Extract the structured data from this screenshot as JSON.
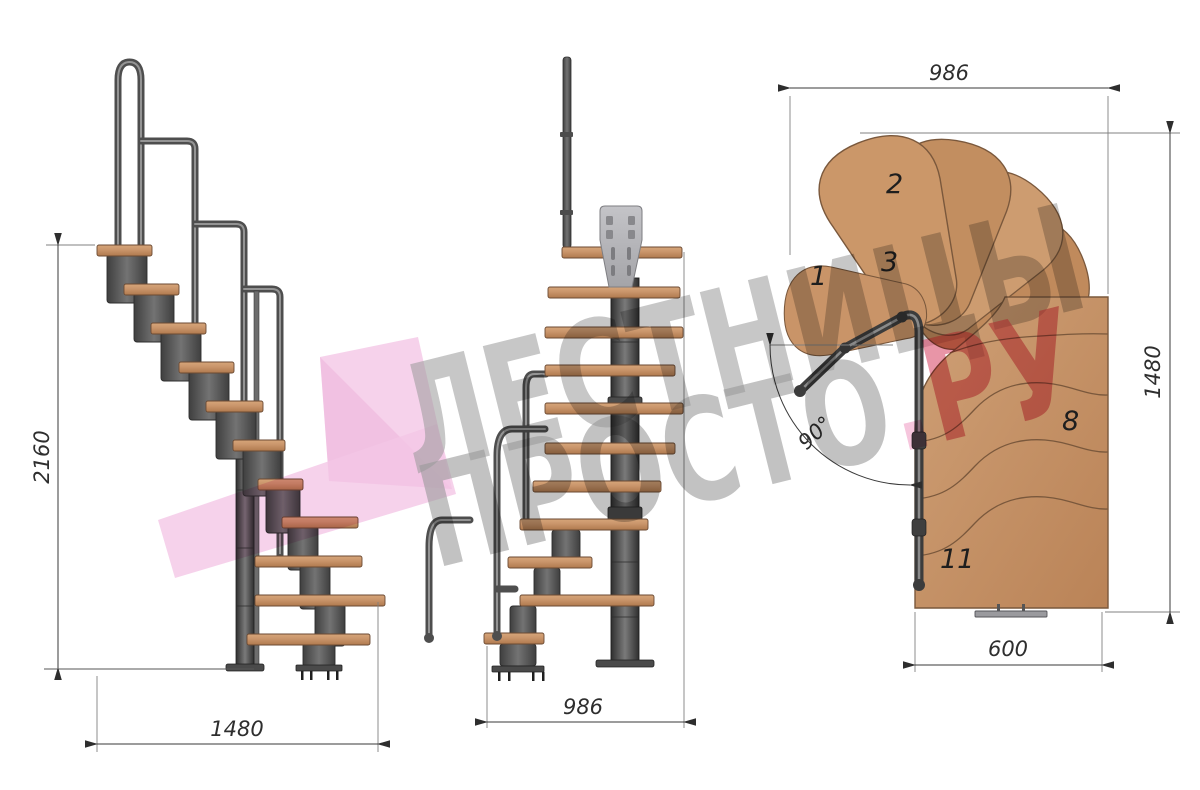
{
  "watermark": {
    "line1": "ЛЕСТНИЦЫ",
    "line2_name": "ПРОСТО",
    "line2_dot": ".",
    "line2_tld": "РУ",
    "text_color": "#999999",
    "tld_color": "#d94f6d",
    "dot_color": "#f0a0c6",
    "ribbon_color": "#f4c7e6"
  },
  "views": {
    "side_elevation": {
      "dim_total_height": "2160",
      "dim_total_run": "1480"
    },
    "front_elevation": {
      "dim_width": "986"
    },
    "plan": {
      "dim_top_width": "986",
      "dim_total_length": "1480",
      "dim_step_width": "600",
      "turn_angle": "90°",
      "step_numbers": [
        "1",
        "2",
        "3",
        "8",
        "11"
      ]
    }
  },
  "colors": {
    "background": "#ffffff",
    "wood_light": "#d2a176",
    "wood": "#c9946a",
    "wood_dark": "#b9835a",
    "metal": "#5a5a5a",
    "metal_dark": "#2d2d2d",
    "plate_gray": "#b6b6ba",
    "dim_line": "#3a3a3a",
    "dim_text": "#2e2e2e"
  }
}
